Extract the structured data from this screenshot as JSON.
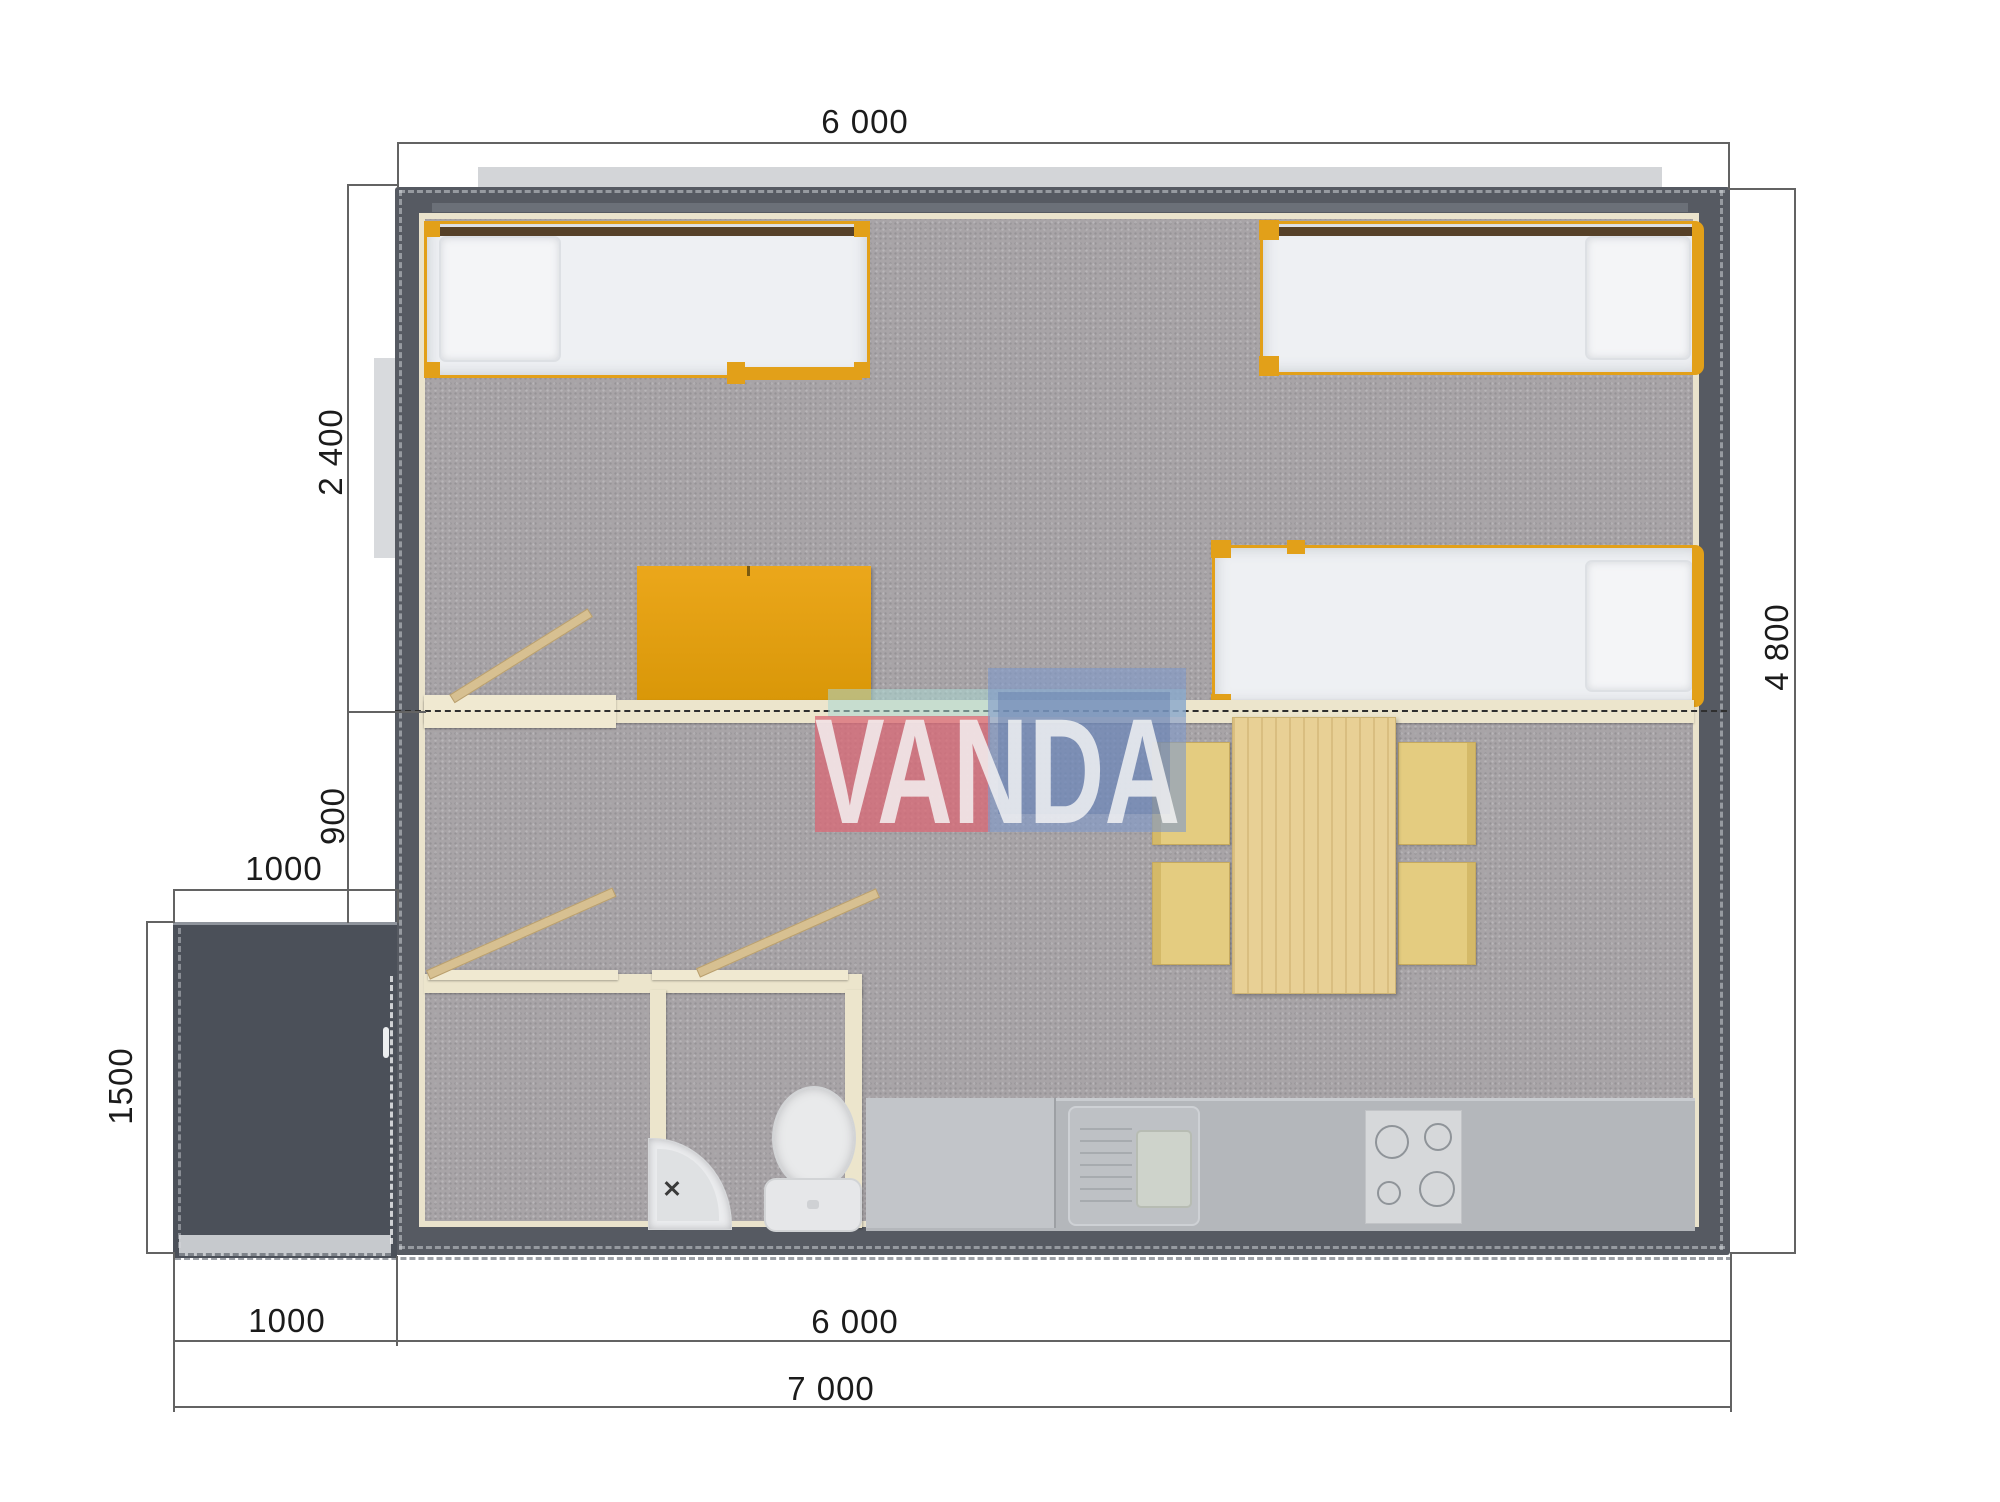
{
  "brand": {
    "name": "VANDA"
  },
  "dims": {
    "top_width": "6 000",
    "right_height": "4 800",
    "left_bedroom_depth": "2 400",
    "left_mid": "900",
    "porch_top_width": "1000",
    "porch_left_height": "1500",
    "bottom_porch": "1000",
    "bottom_house": "6 000",
    "bottom_total": "7 000"
  },
  "colors": {
    "wall": "#565a62",
    "porch": "#4b5059",
    "carpet": "#a8a4a7",
    "inner_lining": "#eae3cc",
    "partition": "#ece5cc",
    "furniture_orange": "#e2a019",
    "door_wood": "#d7c091",
    "table_pine": "#e8d095",
    "chair_yellow": "#e4cc80",
    "counter_gray": "#b4b7bb",
    "mattress_white": "#eef0f3",
    "logo_pink": "#d96976",
    "logo_blue": "#7f9aca",
    "logo_teal": "#a9d7d1"
  }
}
